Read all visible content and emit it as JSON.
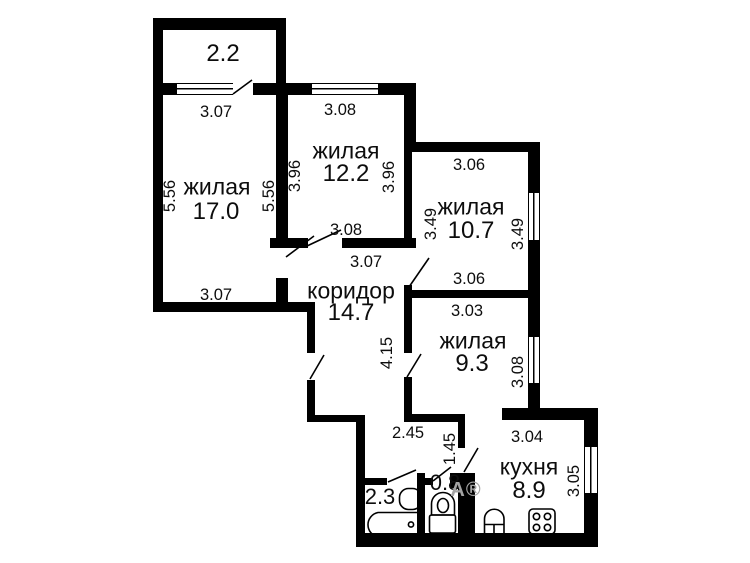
{
  "plan_title": "apartment-floor-plan",
  "colors": {
    "wall": "#000000",
    "background": "#ffffff",
    "text": "#0d0d0d",
    "watermark": "#a3a3a3"
  },
  "labels": {
    "balcony_area": "2.2",
    "room17_name": "жилая",
    "room17_area": "17.0",
    "room12_name": "жилая",
    "room12_area": "12.2",
    "room107_name": "жилая",
    "room107_area": "10.7",
    "room93_name": "жилая",
    "room93_area": "9.3",
    "corridor_name": "коридор",
    "corridor_area": "14.7",
    "kitchen_name": "кухня",
    "kitchen_area": "8.9",
    "bath_area": "2.3",
    "wc_area": "0.8",
    "watermark": "А®"
  },
  "dims": {
    "room17_top": "3.07",
    "room17_left": "5.56",
    "room17_right": "5.56",
    "room17_bottom": "3.07",
    "room12_top": "3.08",
    "room12_left": "3.96",
    "room12_right": "3.96",
    "room12_bottom": "3.08",
    "corridor_top": "3.07",
    "corridor_height": "4.15",
    "room107_top": "3.06",
    "room107_left": "3.49",
    "room107_right": "3.49",
    "room107_bottom": "3.06",
    "room93_top": "3.03",
    "room93_right": "3.08",
    "hall_width": "2.45",
    "hall_height": "1.45",
    "kitchen_top": "3.04",
    "kitchen_right": "3.05"
  },
  "icons": [
    "bathtub-icon",
    "bath-sink-icon",
    "toilet-icon",
    "kitchen-sink-icon",
    "stove-icon",
    "window-symbol",
    "door-swing-line"
  ]
}
